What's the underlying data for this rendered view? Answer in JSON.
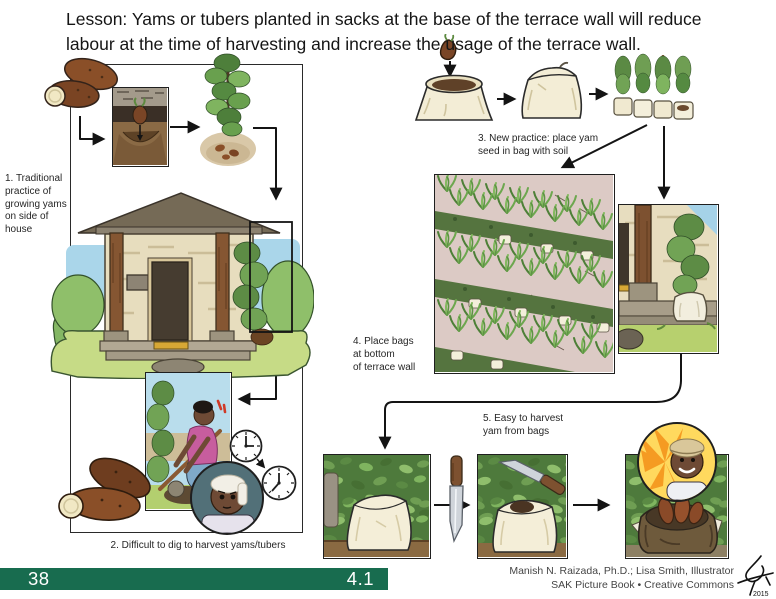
{
  "title": "Lesson: Yams or tubers planted in sacks at the base of the terrace wall will reduce labour at the time of harvesting and increase the usage of the terrace wall.",
  "steps": [
    {
      "label": "1. Traditional\npractice of\ngrowing yams\non side of\nhouse"
    },
    {
      "label": "2. Difficult to dig to harvest yams/tubers"
    },
    {
      "label": "3. New practice: place yam\nseed in bag with soil"
    },
    {
      "label": "4. Place bags\nat bottom\nof terrace wall"
    },
    {
      "label": "5. Easy to harvest\nyam from bags"
    }
  ],
  "footer": {
    "page_number": "38",
    "section_number": "4.1",
    "credit_line1": "Manish N. Raizada, Ph.D.; Lisa Smith, Illustrator",
    "credit_line2": "SAK Picture Book • Creative Commons",
    "signature_year": "2015"
  },
  "colors": {
    "bar_green": "#186c4f",
    "title_text": "#151515",
    "alert_red": "#cf3a28",
    "bag_cream": "#f3edd6",
    "terrace_ground_pink": "#dccac5"
  }
}
